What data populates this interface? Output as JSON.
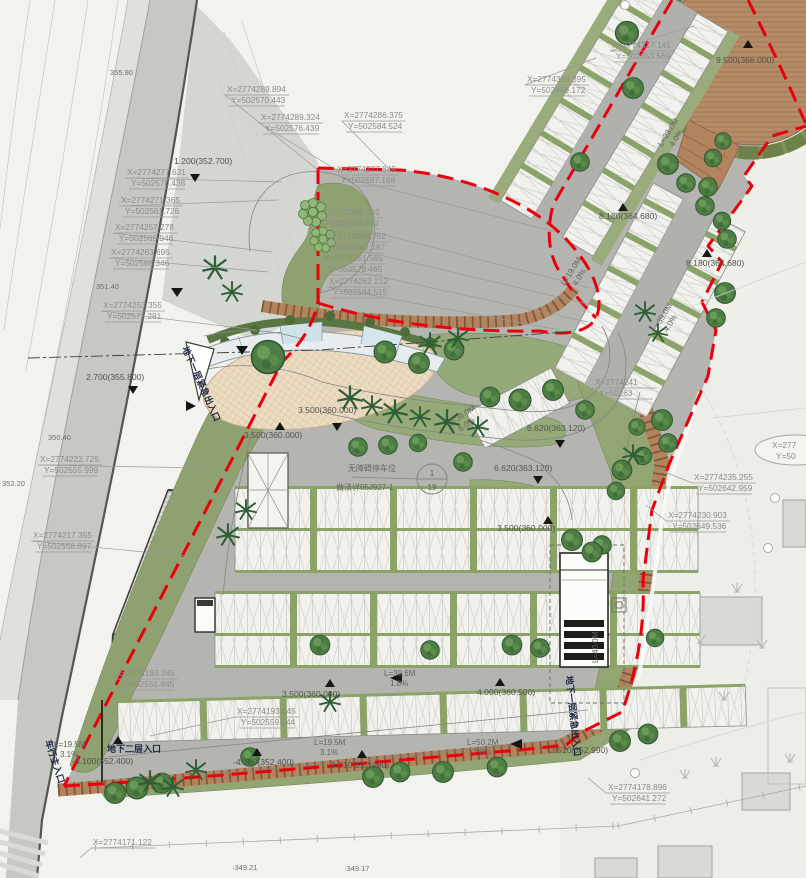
{
  "drawing": {
    "type": "landscape parking site plan",
    "callout": {
      "line1": "无障碍停车位",
      "line2": "做法详05J927-1",
      "num": "1",
      "den": "19"
    },
    "partial_label": {
      "x": "X=277",
      "y": "Y=50"
    },
    "colors": {
      "boundary_red": "#e8000d",
      "site_gray": "#b4b5b1",
      "green": "#94a674",
      "slope_brown": "#b2835c",
      "wood_deck": "#b68b67",
      "plaza_tan": "#ecdcc2",
      "stall_white": "#f1f1ed",
      "glass_blue": "#cfe2ea"
    }
  },
  "coordinate_labels": [
    {
      "x": "X=2774317.141",
      "y": "Y=502653.569",
      "px": 612,
      "py": 48,
      "tx": 694,
      "ty": 26
    },
    {
      "x": "X=2774308.395",
      "y": "Y=502649.172",
      "px": 527,
      "py": 82,
      "tx": 596,
      "ty": 58
    },
    {
      "x": "X=2774289.894",
      "y": "Y=502570.443",
      "px": 227,
      "py": 92,
      "tx": 318,
      "ty": 170
    },
    {
      "x": "X=2774289.324",
      "y": "Y=502576.439",
      "px": 261,
      "py": 120,
      "tx": 340,
      "ty": 172
    },
    {
      "x": "X=2774286.375",
      "y": "Y=502584.524",
      "px": 344,
      "py": 118,
      "tx": 392,
      "ty": 172
    },
    {
      "x": "X=2774277.849",
      "y": "Y=502587.166",
      "px": 337,
      "py": 172,
      "tx": 556,
      "ty": 232
    },
    {
      "x": "X=2774269.282",
      "y": "Y=502584.532",
      "px": 321,
      "py": 215,
      "tx": 590,
      "ty": 288
    },
    {
      "x": "X=2774266.262",
      "y": "Y=502581.187",
      "px": 327,
      "py": 239,
      "tx": 596,
      "ty": 306
    },
    {
      "x": "X=2774261.565",
      "y": "Y=502578.465",
      "px": 324,
      "py": 261,
      "tx": 588,
      "ty": 322
    },
    {
      "x": "X=2774262.212",
      "y": "Y=502584.515",
      "px": 329,
      "py": 284,
      "tx": 560,
      "ty": 330
    },
    {
      "x": "X=2774277.631",
      "y": "Y=502570.438",
      "px": 127,
      "py": 175,
      "tx": 282,
      "ty": 182
    },
    {
      "x": "X=2774271.365",
      "y": "Y=502561.728",
      "px": 121,
      "py": 203,
      "tx": 278,
      "ty": 200
    },
    {
      "x": "X=2774257.278",
      "y": "Y=502565.946",
      "px": 115,
      "py": 230,
      "tx": 272,
      "ty": 252
    },
    {
      "x": "X=2774263.695",
      "y": "Y=502568.346",
      "px": 111,
      "py": 255,
      "tx": 268,
      "ty": 272
    },
    {
      "x": "X=2774253.355",
      "y": "Y=502572.281",
      "px": 103,
      "py": 308,
      "tx": 256,
      "ty": 330
    },
    {
      "x": "X=2774222.725",
      "y": "Y=502555.999",
      "px": 40,
      "py": 462,
      "tx": 205,
      "ty": 468
    },
    {
      "x": "X=2774217.355",
      "y": "Y=502558.897",
      "px": 33,
      "py": 538,
      "tx": 185,
      "ty": 556
    },
    {
      "x": "X=2774235.255",
      "y": "Y=502642.959",
      "px": 694,
      "py": 480,
      "tx": 660,
      "ty": 470
    },
    {
      "x": "X=2774230.903",
      "y": "Y=502649.536",
      "px": 668,
      "py": 518,
      "tx": 646,
      "ty": 505
    },
    {
      "x": "X=2774193.245",
      "y": "Y=502551.845",
      "px": 116,
      "py": 676,
      "tx": 106,
      "ty": 692
    },
    {
      "x": "X=2774193.245",
      "y": "Y=502559.544",
      "px": 237,
      "py": 714,
      "tx": 150,
      "ty": 736
    },
    {
      "x": "X=2774171.122",
      "y": "",
      "px": 93,
      "py": 845,
      "tx": 80,
      "ty": 858
    },
    {
      "x": "X=2774178.896",
      "y": "Y=502641.272",
      "px": 608,
      "py": 790,
      "tx": 588,
      "ty": 778
    },
    {
      "x": "X=2774241",
      "y": "Y=50263",
      "px": 595,
      "py": 385,
      "tx": 585,
      "ty": 398
    }
  ],
  "elevation_markers": [
    {
      "t": "1.200(352.700)",
      "px": 174,
      "py": 164,
      "tx": 195,
      "ty": 177,
      "dir": "down"
    },
    {
      "t": "2.700(355.800)",
      "px": 86,
      "py": 380,
      "tx": 133,
      "ty": 389,
      "dir": "down"
    },
    {
      "t": "3.500(360.000)",
      "px": 244,
      "py": 438,
      "tx": 280,
      "ty": 427,
      "dir": "up"
    },
    {
      "t": "3.500(360.000)",
      "px": 298,
      "py": 413,
      "tx": 337,
      "ty": 426,
      "dir": "down"
    },
    {
      "t": "3.500(360.000)",
      "px": 497,
      "py": 531,
      "tx": 548,
      "ty": 521,
      "dir": "up"
    },
    {
      "t": "3.500(360.000)",
      "px": 282,
      "py": 697,
      "tx": 330,
      "ty": 684,
      "dir": "up"
    },
    {
      "t": "4.000(360.500)",
      "px": 477,
      "py": 695,
      "tx": 500,
      "ty": 683,
      "dir": "up"
    },
    {
      "t": "8.180(364.680)",
      "px": 599,
      "py": 219,
      "tx": 623,
      "ty": 208,
      "dir": "up"
    },
    {
      "t": "8.180(364.680)",
      "px": 686,
      "py": 266,
      "tx": 707,
      "ty": 254,
      "dir": "up"
    },
    {
      "t": "6.620(363.120)",
      "px": 494,
      "py": 471,
      "tx": 538,
      "ty": 479,
      "dir": "down"
    },
    {
      "t": "6.620(363.120)",
      "px": 527,
      "py": 431,
      "tx": 560,
      "ty": 443,
      "dir": "down"
    },
    {
      "t": "9.500(366.000)",
      "px": 716,
      "py": 63,
      "tx": 748,
      "ty": 45,
      "dir": "up"
    },
    {
      "t": "-3.510(352.990)",
      "px": 328,
      "py": 768,
      "tx": 362,
      "ty": 755,
      "dir": "up"
    },
    {
      "t": "-4.100(352.400)",
      "px": 72,
      "py": 764,
      "tx": 118,
      "ty": 741,
      "dir": "up"
    },
    {
      "t": "-4.100(352.400)",
      "px": 233,
      "py": 765,
      "tx": 257,
      "ty": 753,
      "dir": "up"
    },
    {
      "t": "-3.510(352.990)",
      "px": 547,
      "py": 753,
      "tx": 0,
      "ty": 0,
      "dir": "none"
    }
  ],
  "slope_labels": [
    {
      "a": "L=23.0M",
      "b": "4.0%",
      "px": 662,
      "py": 147,
      "rot": -58
    },
    {
      "a": "L=19.0M",
      "b": "4.0%",
      "px": 565,
      "py": 286,
      "rot": -58
    },
    {
      "a": "L=39.0M",
      "b": "4.0%",
      "px": 656,
      "py": 332,
      "rot": -58
    },
    {
      "a": "L=39.0M",
      "b": "6.0%",
      "px": 450,
      "py": 427,
      "rot": -35
    },
    {
      "a": "L=30.6M",
      "b": "1.8%",
      "px": 384,
      "py": 676,
      "rot": 0
    },
    {
      "a": "L=19.5M",
      "b": "3.1%",
      "px": 54,
      "py": 747,
      "rot": 0
    },
    {
      "a": "L=19.5M",
      "b": "3.1%",
      "px": 314,
      "py": 745,
      "rot": 0
    },
    {
      "a": "L=50.2M",
      "b": "7.6%",
      "px": 467,
      "py": 745,
      "rot": 0
    },
    {
      "a": "L=40.0M",
      "b": "",
      "px": 598,
      "py": 663,
      "rot": -90
    }
  ],
  "entrance_labels": [
    {
      "t": "地下一层紧急出入口",
      "px": 182,
      "py": 348,
      "rot": 66
    },
    {
      "t": "车行主入口",
      "px": 45,
      "py": 741,
      "rot": 72
    },
    {
      "t": "地下二层入口",
      "px": 107,
      "py": 752,
      "rot": 0
    },
    {
      "t": "地下一层紧急出入口",
      "px": 566,
      "py": 676,
      "rot": 84
    }
  ],
  "spot_elevations": [
    {
      "t": "355.90",
      "px": 110,
      "py": 75
    },
    {
      "t": "351.40",
      "px": 96,
      "py": 289
    },
    {
      "t": "350.40",
      "px": 48,
      "py": 440
    },
    {
      "t": "352.20",
      "px": 2,
      "py": 486
    },
    {
      "t": "·349.21",
      "px": 232,
      "py": 870
    },
    {
      "t": "·349.17",
      "px": 344,
      "py": 871
    }
  ]
}
